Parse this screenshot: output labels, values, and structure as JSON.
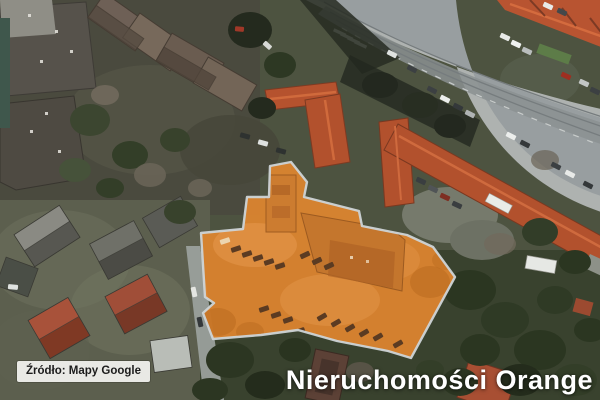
{
  "map_image": {
    "attribution_label": "Źródło: Mapy Google",
    "watermark": "Nieruchomości Orange"
  },
  "highlight_overlay": {
    "name": "highlighted-property-parcel",
    "fill_color": "#df852f",
    "border_color": "#cdd4d7"
  },
  "palette": {
    "roof_red": "#b2512d",
    "road_gray": "#989ea0",
    "vegetation_dark": "#2d3823",
    "attribution_bg": "#e9e9e5",
    "watermark_color": "#ffffff"
  }
}
